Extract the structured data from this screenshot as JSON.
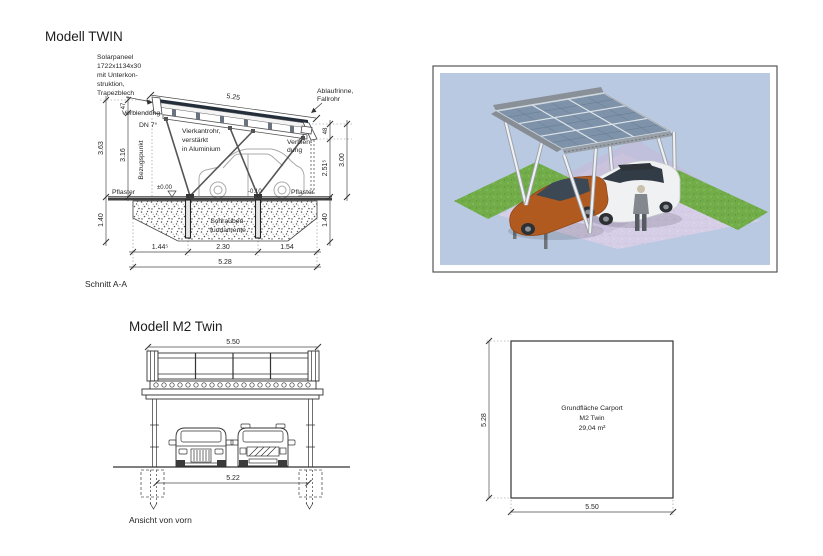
{
  "colors": {
    "line": "#3c3c3c",
    "text": "#262626",
    "render_background": "#b9c9e1",
    "solar_panel": "#7e93a9",
    "grass": "#72ad4a",
    "pavement": "#d6cee7",
    "car_orange": "#b05a20",
    "car_white": "#f0f1f2"
  },
  "section_view": {
    "title": "Modell TWIN",
    "caption": "Schnitt A-A",
    "labels": {
      "solarpaneel": [
        "Solarpaneel",
        "1722x1134x30",
        "mit Unterkon-",
        "struktion,",
        "Trapezblech"
      ],
      "verblendung_left": "Verblendung",
      "slope": "DN 7°",
      "vierkantrohr": [
        "Vierkantrohr,",
        "verstärkt",
        "in Aluminium"
      ],
      "ablaufrinne": [
        "Ablaufrinne,",
        "Fallrohr"
      ],
      "verblendung_right": [
        "Verblen-",
        "dung"
      ],
      "bezugspunkt": "Bezugspunkt",
      "pflaster_left": "Pflaster",
      "pflaster_right": "Pflaster",
      "level_zero": "±0.00",
      "level_minus": "-0.10",
      "fundamente": [
        "Schrauben-",
        "fundamente"
      ]
    },
    "dims": {
      "roof_length": "5.25",
      "panel_offset": "47",
      "height_total": "3.63",
      "height_clear": "3.16",
      "gutter_offset": "48",
      "height_eave": "2.51⁵",
      "height_right": "3.00",
      "depth_left": "1.40",
      "depth_right": "1.40",
      "bay_left": "1.44⁵",
      "bay_mid": "2.30",
      "bay_right": "1.54",
      "width_total": "5.28"
    }
  },
  "front_view": {
    "title": "Modell M2 Twin",
    "caption": "Ansicht von vorn",
    "dims": {
      "width_roof": "5.50",
      "width_clear": "5.22"
    }
  },
  "floor_plan": {
    "label_lines": [
      "Grundfläche Carport",
      "M2 Twin",
      "29,04 m²"
    ],
    "dims": {
      "depth": "5.28",
      "width": "5.50"
    }
  }
}
